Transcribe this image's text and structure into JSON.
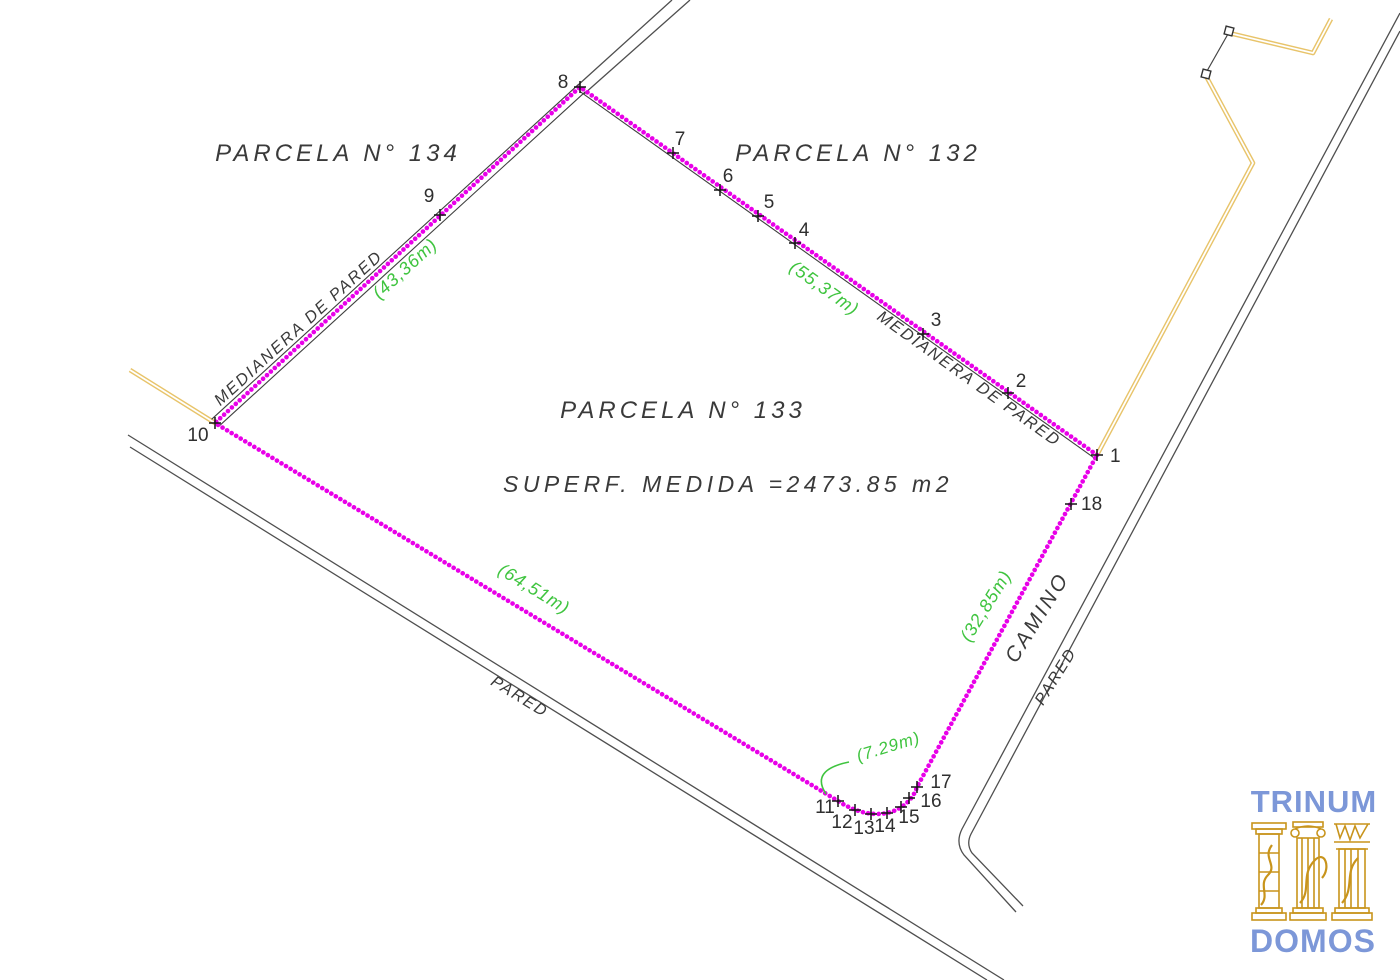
{
  "colors": {
    "boundary": "#e800e8",
    "measurement": "#3fc43f",
    "wall_line": "#3f3f3f",
    "road_line": "#4f4f4f",
    "yellow_line": "#e8c46a",
    "text": "#3a3a3a",
    "logo_text": "#7c97d8",
    "logo_gold": "#c8941c"
  },
  "parcels": {
    "p134": "PARCELA N° 134",
    "p132": "PARCELA N° 132",
    "p133": "PARCELA N° 133",
    "area": "SUPERF. MEDIDA =2473.85 m2"
  },
  "labels": {
    "medianera_left": "MEDIANERA DE PARED",
    "medianera_right": "MEDIANERA DE PARED",
    "pared_bottom": "PARED",
    "pared_right": "PARED",
    "camino": "CAMINO"
  },
  "measurements": {
    "left": "(43,36m)",
    "upper_right": "(55,37m)",
    "bottom": "(64,51m)",
    "camino_side": "(32,85m)",
    "corner_curve": "(7.29m)"
  },
  "vertices": [
    {
      "label": "1"
    },
    {
      "label": "2"
    },
    {
      "label": "3"
    },
    {
      "label": "4"
    },
    {
      "label": "5"
    },
    {
      "label": "6"
    },
    {
      "label": "7"
    },
    {
      "label": "8"
    },
    {
      "label": "9"
    },
    {
      "label": "10"
    },
    {
      "label": "11"
    },
    {
      "label": "12"
    },
    {
      "label": "13"
    },
    {
      "label": "14"
    },
    {
      "label": "15"
    },
    {
      "label": "16"
    },
    {
      "label": "17"
    },
    {
      "label": "18"
    }
  ],
  "logo": {
    "top": "TRINUM",
    "bottom": "DOMOS"
  }
}
